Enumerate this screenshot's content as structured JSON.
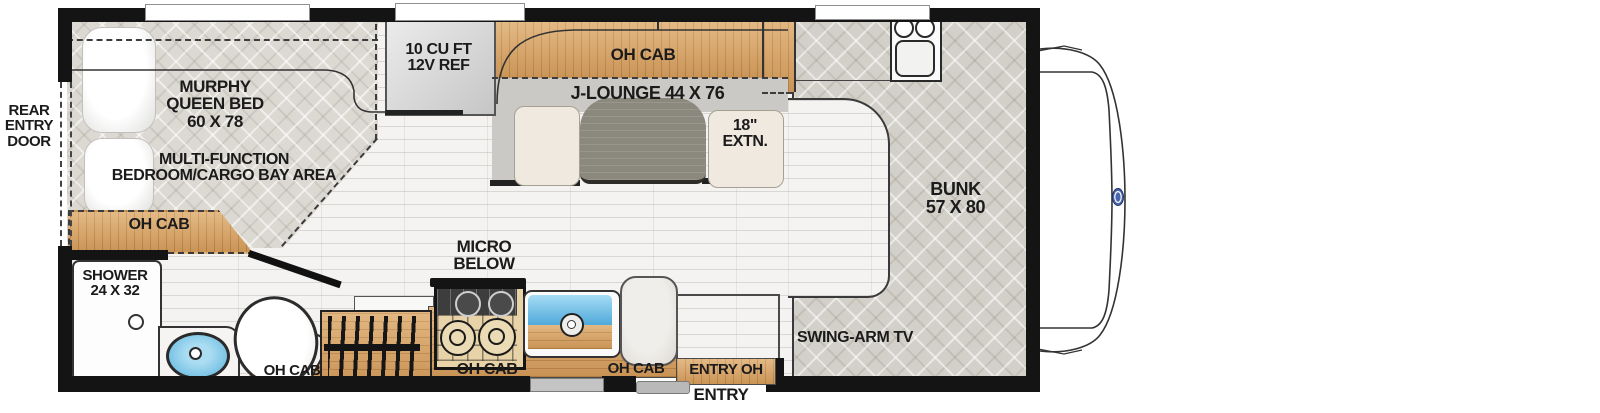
{
  "title": "RV floor plan",
  "labels": {
    "rear_entry_door": "REAR\nENTRY\nDOOR",
    "murphy_bed": "MURPHY\nQUEEN BED\n60 X 78",
    "multi_function_area": "MULTI-FUNCTION\nBEDROOM/CARGO BAY AREA",
    "oh_cab_bedroom": "OH CAB",
    "shower": "SHOWER\n24 X 32",
    "refrigerator": "10 CU FT\n12V REF",
    "oh_cab_galley": "OH CAB",
    "j_lounge": "J-LOUNGE 44 X 76",
    "table_extension": "18\"\nEXTN.",
    "micro_below": "MICRO\nBELOW",
    "oh_cab_bath": "OH CAB",
    "oh_cab_range": "OH CAB",
    "oh_cab_sink": "OH CAB",
    "entry_oh": "ENTRY OH",
    "entry": "ENTRY",
    "bunk": "BUNK\n57 X 80",
    "swing_arm_tv": "SWING-ARM TV"
  },
  "fixtures": [
    "pillows",
    "murphy-queen-bed",
    "overhead-cabinets",
    "shower-pan",
    "vanity-sink",
    "toilet",
    "stairs",
    "range-cooktop",
    "kitchen-sink",
    "counter-chair",
    "refrigerator",
    "dinette-table",
    "lounge-cushions",
    "bunk-mattress",
    "entry-step",
    "entry-door",
    "rear-entry-door",
    "windows",
    "cab-hood",
    "ford-logo"
  ],
  "colors": {
    "wall": "#141414",
    "wood": "#d8a263",
    "quilt_fabric": "#dcd9d3",
    "floor": "#f4f3f1",
    "sink_blue": "#6ec4e8",
    "table": "#8b887e",
    "cushion": "#efe9df",
    "logo_blue": "#4866b0"
  }
}
